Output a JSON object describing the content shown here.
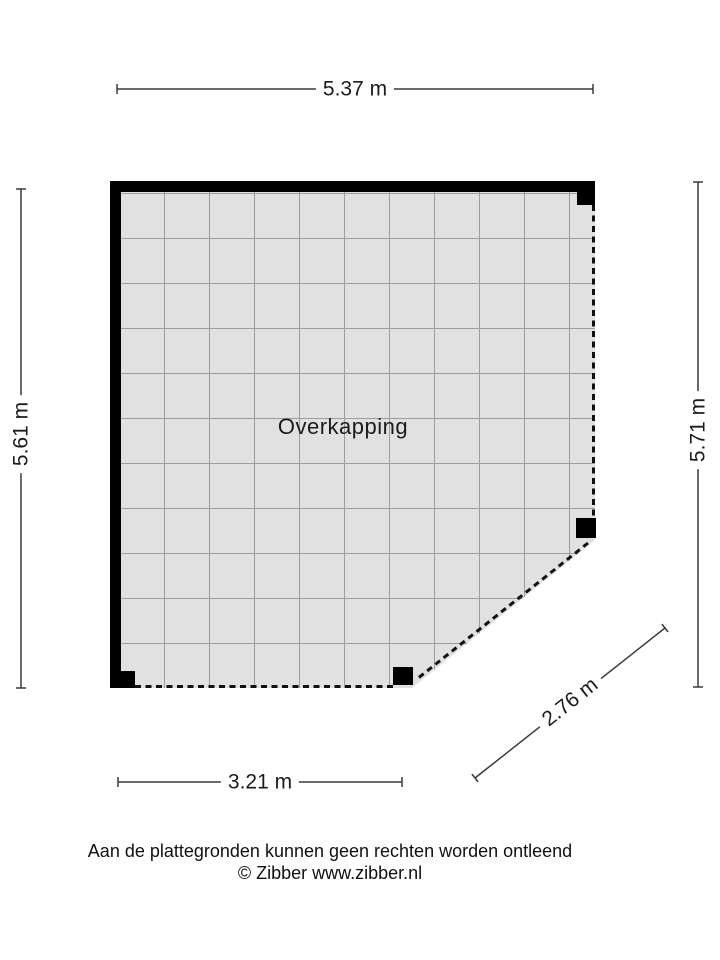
{
  "floorplan": {
    "room_label": "Overkapping",
    "dimensions": {
      "top": "5.37 m",
      "left": "5.61 m",
      "right": "5.71 m",
      "bottom": "3.21 m",
      "diagonal": "2.76 m"
    },
    "footer": {
      "disclaimer": "Aan de plattegronden kunnen geen rechten worden ontleend",
      "credit": "© Zibber www.zibber.nl"
    },
    "colors": {
      "floor_fill": "#e1e1e1",
      "grid_line": "#9c9c9c",
      "wall": "#000000",
      "dimension_line": "#3a3a3a",
      "text": "#1b1b1b"
    }
  }
}
